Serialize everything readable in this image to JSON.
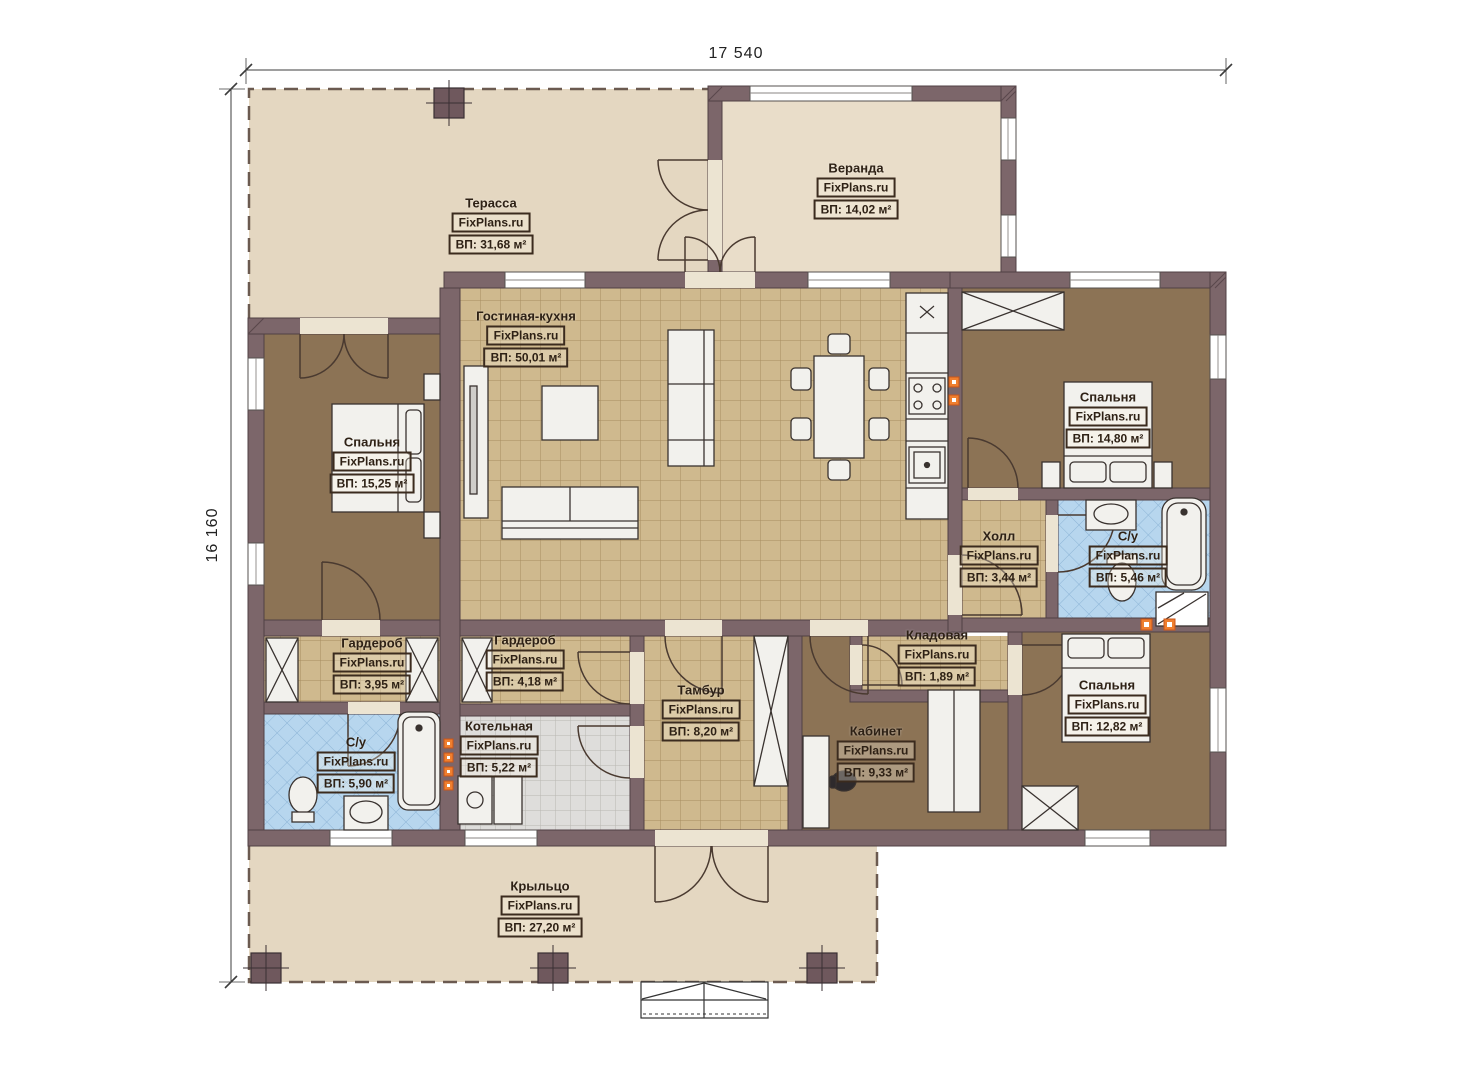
{
  "meta": {
    "watermark": "FixPlans.ru"
  },
  "dimensions": {
    "top": "17 540",
    "left": "16 160"
  },
  "rooms": [
    {
      "name": "Терасса",
      "area": "ВП: 31,68 м²"
    },
    {
      "name": "Веранда",
      "area": "ВП: 14,02 м²"
    },
    {
      "name": "Гостиная-кухня",
      "area": "ВП: 50,01 м²"
    },
    {
      "name": "Спальня",
      "area": "ВП: 15,25 м²"
    },
    {
      "name": "Спальня",
      "area": "ВП: 14,80 м²"
    },
    {
      "name": "Холл",
      "area": "ВП: 3,44 м²"
    },
    {
      "name": "С/у",
      "area": "ВП: 5,46 м²"
    },
    {
      "name": "Гардероб",
      "area": "ВП: 3,95 м²"
    },
    {
      "name": "Гардероб",
      "area": "ВП: 4,18 м²"
    },
    {
      "name": "Котельная",
      "area": "ВП: 5,22 м²"
    },
    {
      "name": "С/у",
      "area": "ВП: 5,90 м²"
    },
    {
      "name": "Тамбур",
      "area": "ВП: 8,20 м²"
    },
    {
      "name": "Кладовая",
      "area": "ВП: 1,89 м²"
    },
    {
      "name": "Кабинет",
      "area": "ВП: 9,33 м²"
    },
    {
      "name": "Спальня",
      "area": "ВП: 12,82 м²"
    },
    {
      "name": "Крыльцо",
      "area": "ВП: 27,20 м²"
    }
  ],
  "colors": {
    "wall": "#7c666a",
    "outdoor": "#e4d7c1",
    "veranda": "#e9ddc9",
    "tile_tan": "#cfb98e",
    "tile_blue": "#b7d6ee",
    "tile_gray": "#dedddb",
    "room_brown": "#8c7355",
    "accent_orange": "#ef7f2f"
  }
}
